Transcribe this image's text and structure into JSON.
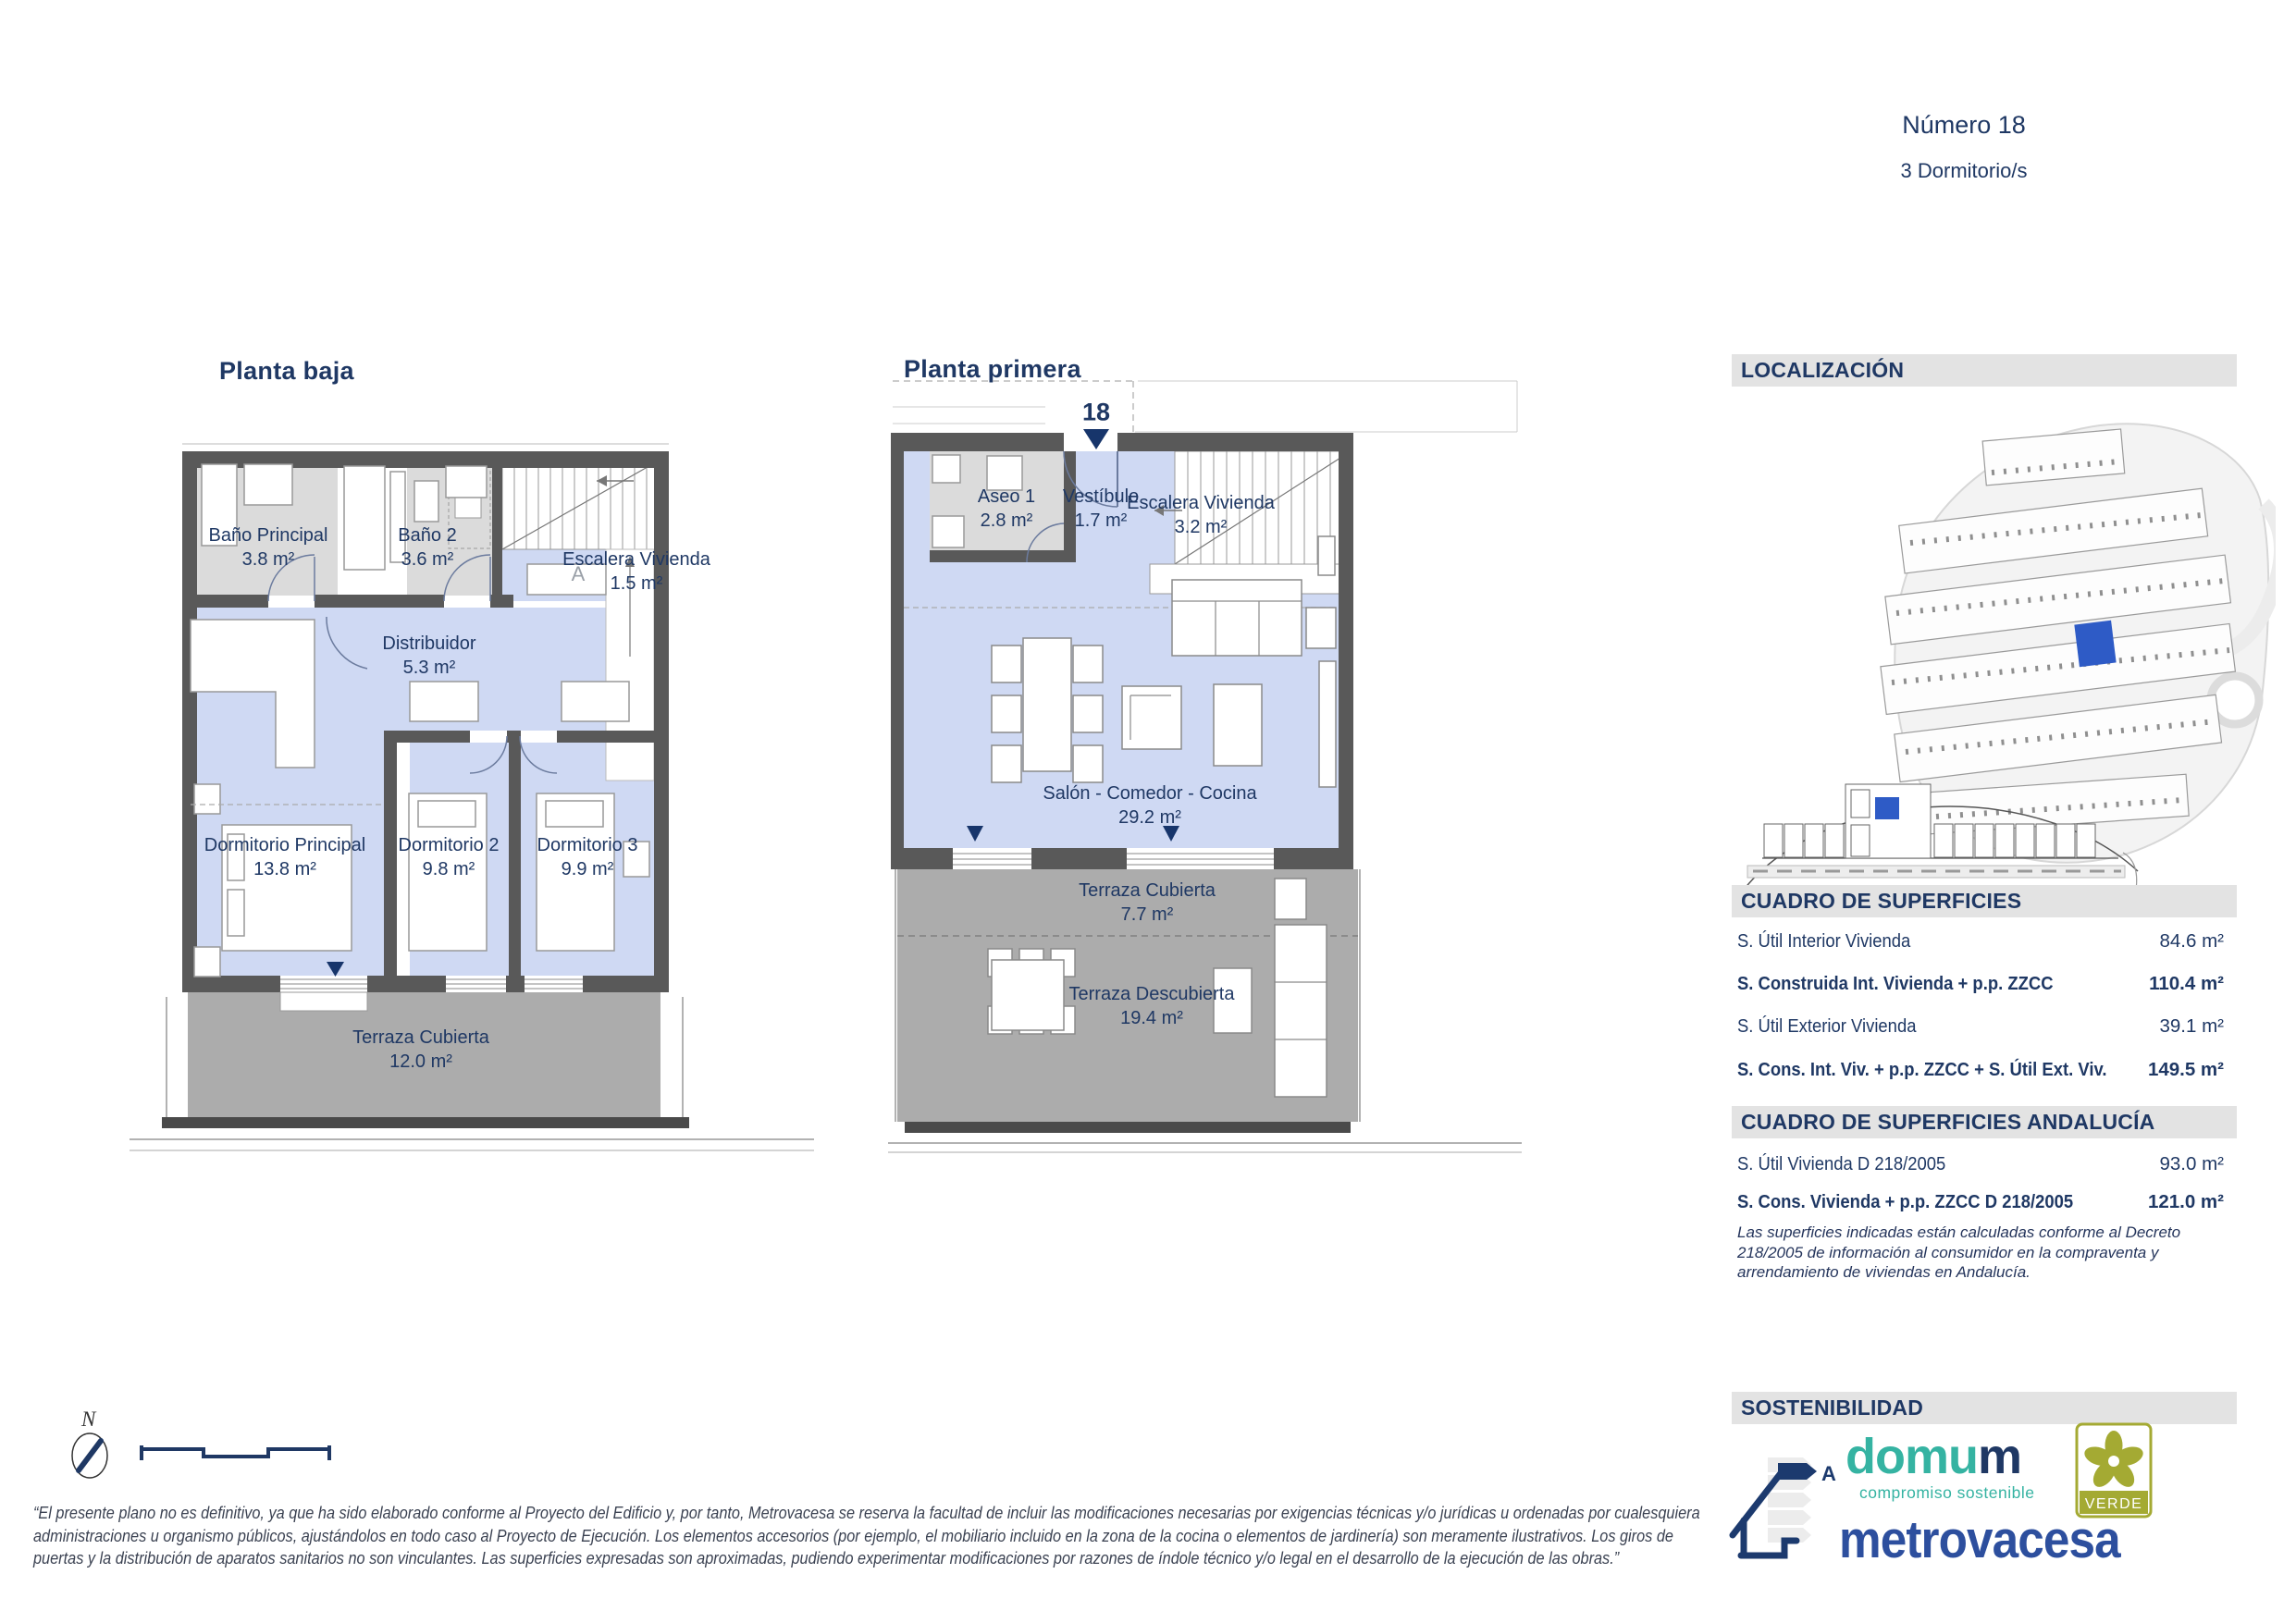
{
  "header": {
    "number": "Número 18",
    "bedrooms": "3 Dormitorio/s"
  },
  "plans": {
    "ground": {
      "title": "Planta baja",
      "stair_zone_label": "A",
      "rooms": [
        {
          "name": "Baño Principal",
          "area": "3.8 m²"
        },
        {
          "name": "Baño 2",
          "area": "3.6 m²"
        },
        {
          "name": "Escalera Vivienda",
          "area": "1.5 m²"
        },
        {
          "name": "Distribuidor",
          "area": "5.3 m²"
        },
        {
          "name": "Dormitorio Principal",
          "area": "13.8 m²"
        },
        {
          "name": "Dormitorio 2",
          "area": "9.8 m²"
        },
        {
          "name": "Dormitorio 3",
          "area": "9.9 m²"
        },
        {
          "name": "Terraza Cubierta",
          "area": "12.0 m²"
        }
      ]
    },
    "first": {
      "title": "Planta primera",
      "unit_number": "18",
      "rooms": [
        {
          "name": "Aseo 1",
          "area": "2.8 m²"
        },
        {
          "name": "Vestíbulo",
          "area": "1.7 m²"
        },
        {
          "name": "Escalera Vivienda",
          "area": "3.2 m²"
        },
        {
          "name": "Salón - Comedor - Cocina",
          "area": "29.2 m²"
        },
        {
          "name": "Terraza Cubierta",
          "area": "7.7 m²"
        },
        {
          "name": "Terraza Descubierta",
          "area": "19.4 m²"
        }
      ]
    }
  },
  "location": {
    "title": "LOCALIZACIÓN"
  },
  "surface_table": {
    "title": "CUADRO DE SUPERFICIES",
    "rows": [
      {
        "label": "S. Útil Interior Vivienda",
        "value": "84.6 m²"
      },
      {
        "label": "S. Construida Int. Vivienda + p.p. ZZCC",
        "value": "110.4 m²"
      },
      {
        "label": "S. Útil Exterior Vivienda",
        "value": "39.1 m²"
      },
      {
        "label": "S. Cons. Int. Viv. + p.p. ZZCC + S. Útil Ext. Viv.",
        "value": "149.5 m²"
      }
    ]
  },
  "surface_table_andalucia": {
    "title": "CUADRO DE SUPERFICIES ANDALUCÍA",
    "rows": [
      {
        "label": "S. Útil Vivienda D 218/2005",
        "value": "93.0 m²"
      },
      {
        "label": "S. Cons. Vivienda + p.p. ZZCC D 218/2005",
        "value": "121.0 m²"
      }
    ],
    "note": "Las superficies indicadas están calculadas conforme al Decreto 218/2005 de información al consumidor en la compraventa y arrendamiento de viviendas en Andalucía."
  },
  "sustainability": {
    "title": "SOSTENIBILIDAD",
    "energy_letter": "A",
    "domum_part1": "domu",
    "domum_part2": "m",
    "domum_tagline": "compromiso sostenible",
    "verde_label": "VERDE",
    "brand": "metrovacesa"
  },
  "compass_label": "N",
  "disclaimer_lines": [
    "“El presente plano no es definitivo, ya que ha sido elaborado conforme al Proyecto del Edificio y, por tanto, Metrovacesa se reserva la facultad de incluir las modificaciones necesarias por exigencias técnicas y/o jurídicas u ordenadas por cualesquiera",
    "administraciones u organismo públicos, ajustándolos en todo caso al Proyecto de Ejecución. Los elementos accesorios (por ejemplo, el mobiliario incluido en la zona de la cocina o elementos de jardinería) son meramente ilustrativos. Los giros de",
    "puertas y la distribución de aparatos sanitarios no son vinculantes. Las superficies expresadas son aproximadas, pudiendo experimentar modificaciones por razones de índole técnico y/o legal en el desarrollo de la ejecución de las obras.”"
  ],
  "colors": {
    "navy": "#1F3864",
    "floor_blue": "#CFD9F3",
    "bath_gray": "#DBDBDB",
    "wall_gray": "#595959",
    "terrace_gray": "#ACACAC",
    "bar_bg": "#E3E3E3",
    "highlight_blue": "#2E5BC6",
    "teal": "#35B3A2",
    "brand_blue": "#2D4F9E",
    "verde_olive": "#A4AA33"
  }
}
